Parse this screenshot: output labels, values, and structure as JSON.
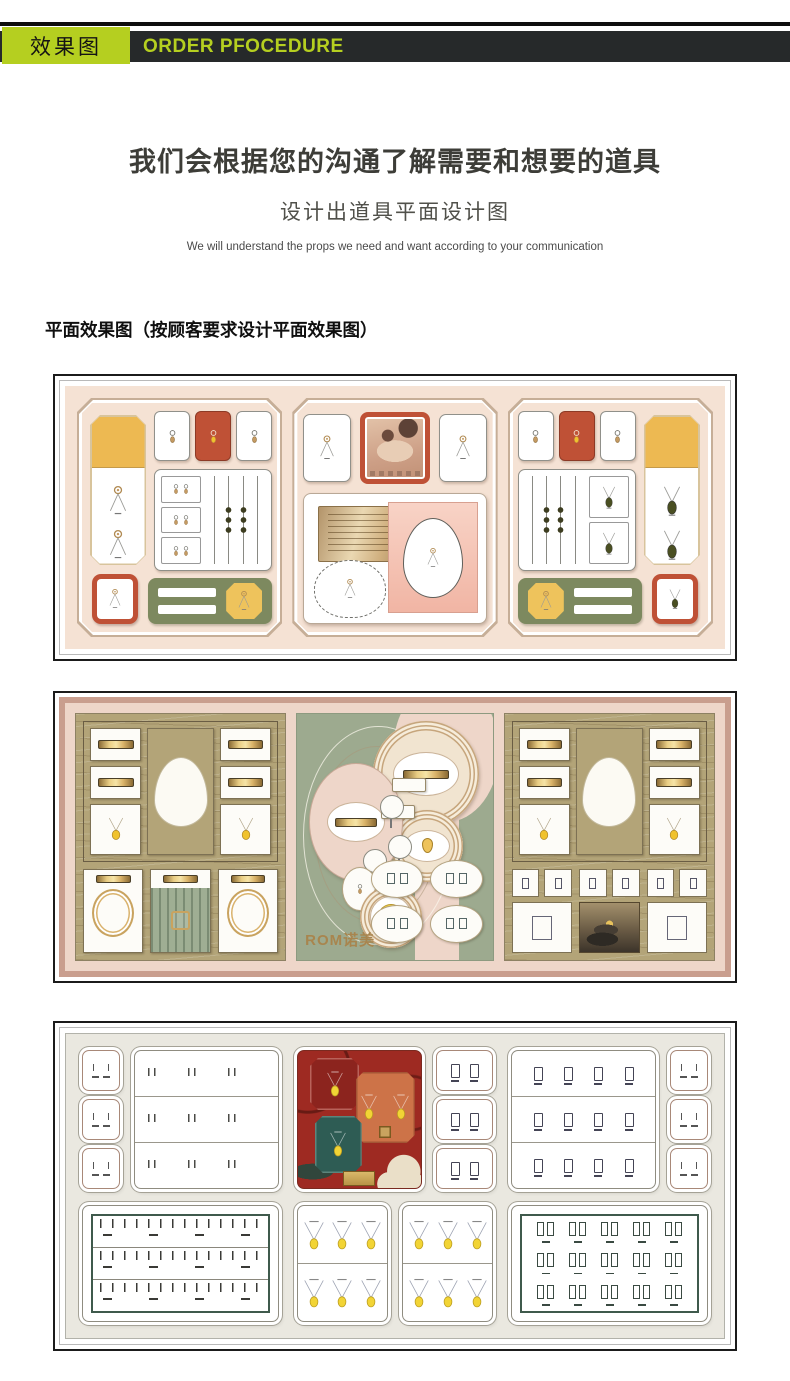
{
  "header": {
    "badge_label": "效果图",
    "bar_title": "ORDER PFOCEDURE"
  },
  "intro": {
    "heading_cn": "我们会根据您的沟通了解需要和想要的道具",
    "subheading_cn": "设计出道具平面设计图",
    "description_en": "We will understand the props we need and want according to your communication"
  },
  "section": {
    "label": "平面效果图（按顾客要求设计平面效果图）"
  },
  "renderings": {
    "brand_logo": "ROM诺美",
    "count": 3
  },
  "icons": {
    "pendant_necklace": "ring-clasp-with-v-chain-and-slot",
    "earring": "stud-circle-with-gold-drop",
    "necklace_yellow": "v-chain-with-yellow-drop",
    "necklace_gold": "v-chain-with-gold-drop",
    "pendant_leaf": "v-chain-with-dark-leaf-drop"
  },
  "colors": {
    "accent": "#b5cf20",
    "bar": "#26292a",
    "pink": "#f5e2d4",
    "red": "#bf5136",
    "amber": "#edb952",
    "amber2": "#eec35c",
    "olive": "#7d895f",
    "rose": "#c99e8e",
    "roselight": "#eed6c9",
    "khaki": "#b3a478",
    "sage": "#9daa8f",
    "beige": "#eae8e0",
    "darkred": "#9e2a22",
    "teal": "#2e5c54",
    "orange": "#cd7348",
    "gold": "#c9a35f",
    "yellow": "#f2d435"
  }
}
